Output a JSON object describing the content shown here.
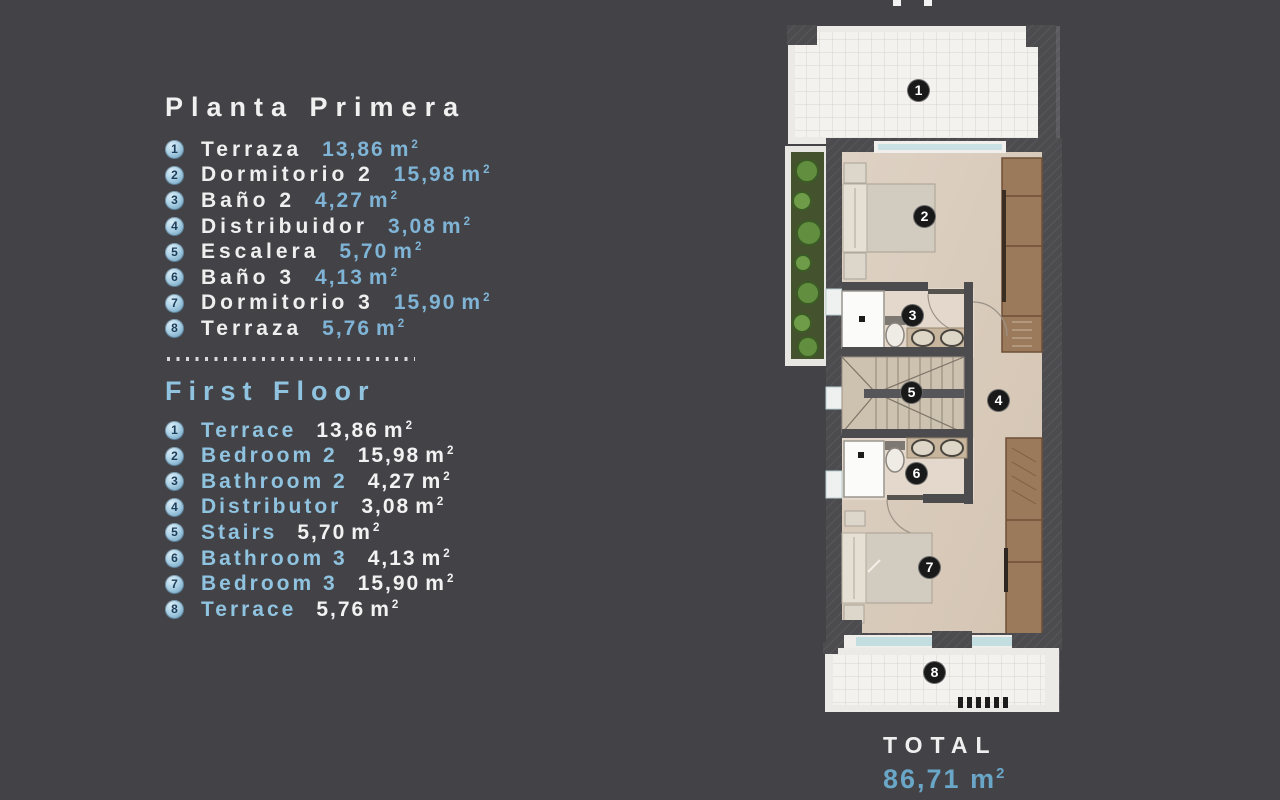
{
  "legend": {
    "unit": "m",
    "unit_sup": "2",
    "planta": {
      "title": "Planta Primera",
      "items": [
        {
          "num": "1",
          "name": "Terraza",
          "area": "13,86"
        },
        {
          "num": "2",
          "name": "Dormitorio 2",
          "area": "15,98"
        },
        {
          "num": "3",
          "name": "Baño 2",
          "area": "4,27"
        },
        {
          "num": "4",
          "name": "Distribuidor",
          "area": "3,08"
        },
        {
          "num": "5",
          "name": "Escalera",
          "area": "5,70"
        },
        {
          "num": "6",
          "name": "Baño 3",
          "area": "4,13"
        },
        {
          "num": "7",
          "name": "Dormitorio 3",
          "area": "15,90"
        },
        {
          "num": "8",
          "name": "Terraza",
          "area": "5,76"
        }
      ]
    },
    "first_floor": {
      "title": "First Floor",
      "items": [
        {
          "num": "1",
          "name": "Terrace",
          "area": "13,86"
        },
        {
          "num": "2",
          "name": "Bedroom 2",
          "area": "15,98"
        },
        {
          "num": "3",
          "name": "Bathroom 2",
          "area": "4,27"
        },
        {
          "num": "4",
          "name": "Distributor",
          "area": "3,08"
        },
        {
          "num": "5",
          "name": "Stairs",
          "area": "5,70"
        },
        {
          "num": "6",
          "name": "Bathroom 3",
          "area": "4,13"
        },
        {
          "num": "7",
          "name": "Bedroom 3",
          "area": "15,90"
        },
        {
          "num": "8",
          "name": "Terrace",
          "area": "5,76"
        }
      ]
    }
  },
  "plan": {
    "markers": [
      {
        "num": "1"
      },
      {
        "num": "2"
      },
      {
        "num": "3"
      },
      {
        "num": "4"
      },
      {
        "num": "5"
      },
      {
        "num": "6"
      },
      {
        "num": "7"
      },
      {
        "num": "8"
      }
    ],
    "total": {
      "label": "TOTAL",
      "value": "86,71",
      "unit": "m",
      "unit_sup": "2"
    }
  },
  "colors": {
    "background": "#434347",
    "accent_blue_values": "#7fb4d6",
    "accent_blue_heading": "#8fc3e0",
    "badge_fill": "#a9cfe4",
    "marker_fill": "#191919",
    "wall_gray": "#4c4c4f",
    "floor_beige": "#d9cbbc",
    "wardrobe_brown": "#9a7a5b",
    "plant_green": "#628f3f"
  }
}
